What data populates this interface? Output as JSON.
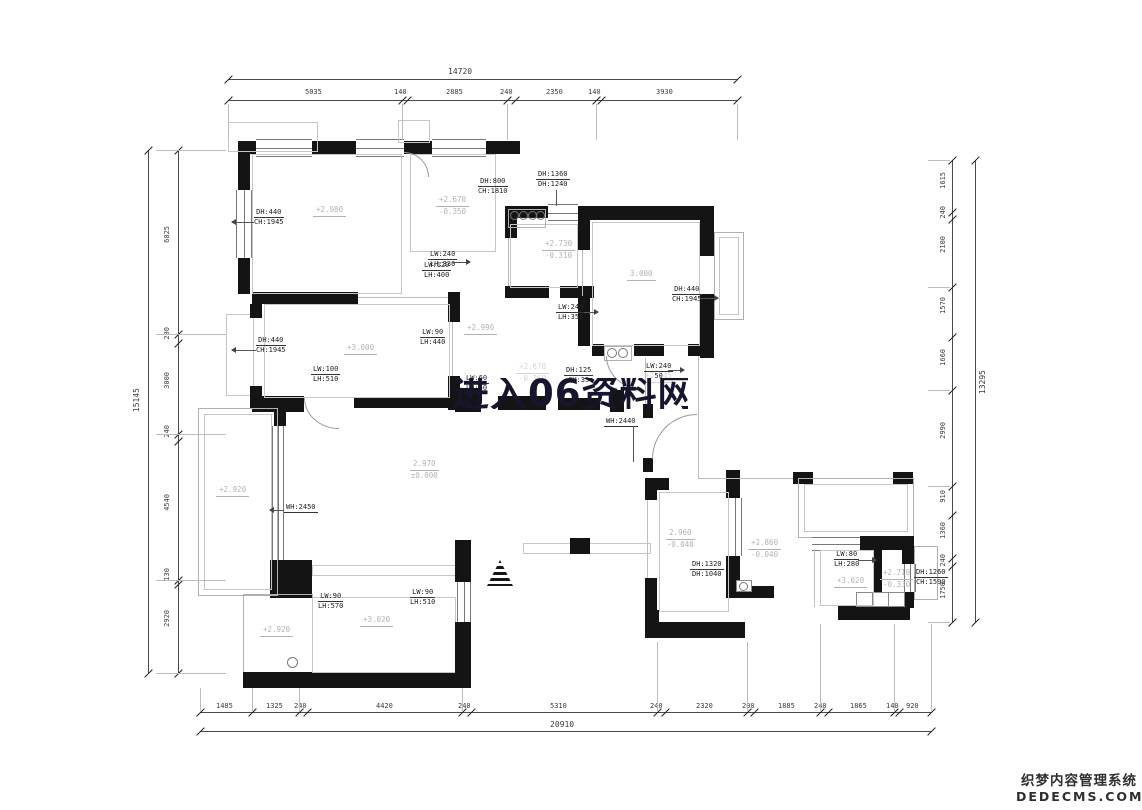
{
  "drawing": {
    "watermark_text": "进入06资料网",
    "cms_logo": {
      "line1": "织梦内容管理系统",
      "line2": "DEDECMS.COM"
    },
    "colors": {
      "wall": "#141414",
      "dimension": "#4a4a4a",
      "level_text": "#b2b2b2",
      "annotation_text": "#222222",
      "watermark": "#15152e"
    }
  },
  "dimensions": {
    "top": {
      "total": "14720",
      "segments": [
        "5035",
        "140",
        "2885",
        "240",
        "2350",
        "140",
        "3930"
      ]
    },
    "bottom": {
      "total": "20910",
      "segments": [
        "1485",
        "1325",
        "240",
        "4420",
        "240",
        "5310",
        "240",
        "2320",
        "200",
        "1885",
        "240",
        "1865",
        "140",
        "920"
      ]
    },
    "left": {
      "total": "15145",
      "segments": [
        "6025",
        "290",
        "3000",
        "240",
        "4540",
        "130",
        "2920"
      ]
    },
    "right": {
      "total": "13295",
      "segments": [
        "1615",
        "240",
        "2100",
        "1570",
        "1660",
        "2990",
        "910",
        "1360",
        "240",
        "1750"
      ]
    }
  },
  "levels": [
    {
      "lines": [
        "+2.980"
      ]
    },
    {
      "lines": [
        "+2.670",
        "-0.350"
      ]
    },
    {
      "lines": [
        "+2.730",
        "-0.310"
      ]
    },
    {
      "lines": [
        "3.000"
      ]
    },
    {
      "lines": [
        "+2.990"
      ]
    },
    {
      "lines": [
        "+3.000"
      ]
    },
    {
      "lines": [
        "+2.670",
        "-0.360"
      ]
    },
    {
      "lines": [
        "+2.745"
      ]
    },
    {
      "lines": [
        "2.970",
        "±0.000"
      ]
    },
    {
      "lines": [
        "+2.920"
      ]
    },
    {
      "lines": [
        "+2.920"
      ]
    },
    {
      "lines": [
        "+3.020"
      ]
    },
    {
      "lines": [
        "2.960",
        "-0.040"
      ]
    },
    {
      "lines": [
        "+2.860",
        "-0.040"
      ]
    },
    {
      "lines": [
        "+3.020"
      ]
    },
    {
      "lines": [
        "+2.710",
        "-0.330"
      ]
    }
  ],
  "openings": [
    {
      "lines": [
        "DH:440",
        "CH:1945"
      ]
    },
    {
      "lines": [
        "DH:1360",
        "DH:1240"
      ]
    },
    {
      "lines": [
        "DH:800",
        "CH:1810"
      ]
    },
    {
      "lines": [
        "LW:240",
        "LH:330"
      ]
    },
    {
      "lines": [
        "LW:120",
        "LH:400"
      ]
    },
    {
      "lines": [
        "LW:240",
        "LH:350"
      ]
    },
    {
      "lines": [
        "DH:440",
        "CH:1945"
      ]
    },
    {
      "lines": [
        "LW:90",
        "LH:440"
      ]
    },
    {
      "lines": [
        "DH:440",
        "CH:1945"
      ]
    },
    {
      "lines": [
        "LW:100",
        "LH:510"
      ]
    },
    {
      "lines": [
        "LW:60",
        "LH:50"
      ]
    },
    {
      "lines": [
        "DH:125",
        "CH:35"
      ]
    },
    {
      "lines": [
        "LW:240",
        "50"
      ]
    },
    {
      "lines": [
        "WH:2440"
      ]
    },
    {
      "lines": [
        "WH:2450"
      ]
    },
    {
      "lines": [
        "LW:90",
        "LH:570"
      ]
    },
    {
      "lines": [
        "LW:90",
        "LH:510"
      ]
    },
    {
      "lines": [
        "DH:1320",
        "DH:1040"
      ]
    },
    {
      "lines": [
        "LW:80",
        "LH:280"
      ]
    },
    {
      "lines": [
        "DH:1260",
        "CH:1590"
      ]
    }
  ]
}
